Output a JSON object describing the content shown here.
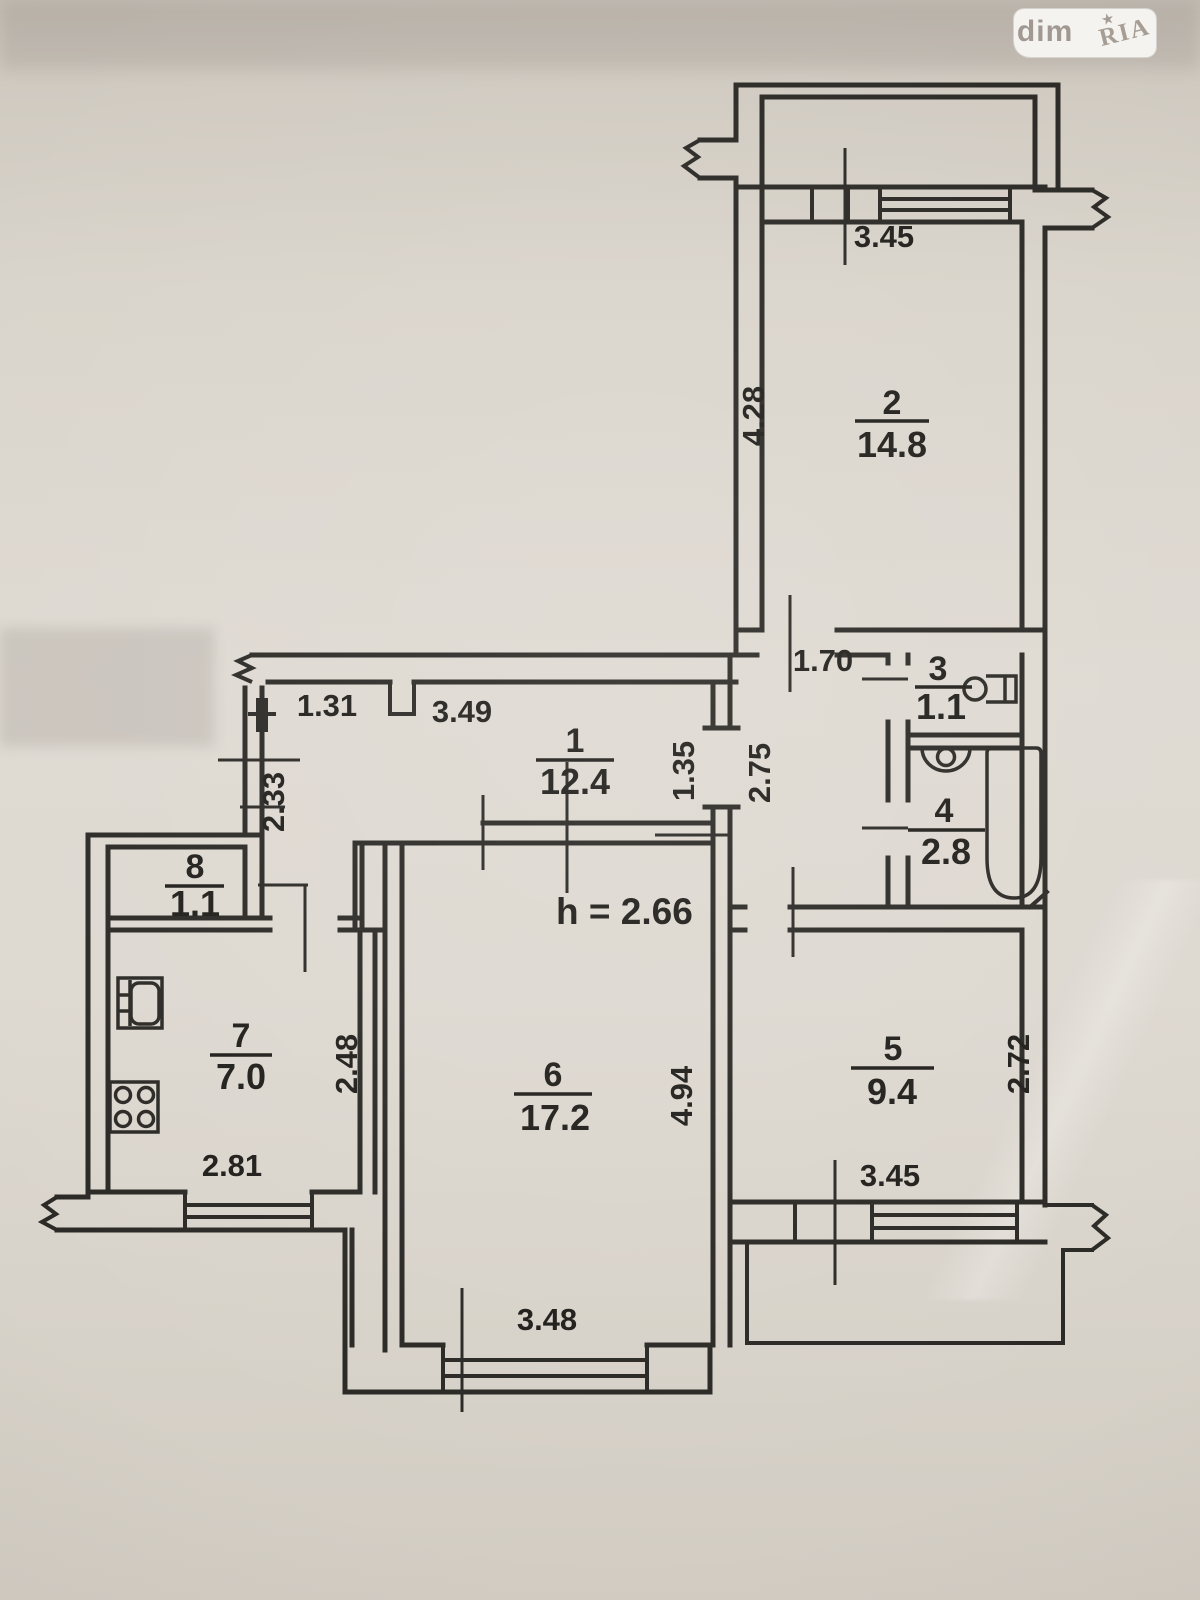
{
  "logo": {
    "left": "dim",
    "right": "RIA",
    "star": "★"
  },
  "plan": {
    "height_note": "h = 2.66",
    "rooms": {
      "r1": {
        "number": "1",
        "area": "12.4"
      },
      "r2": {
        "number": "2",
        "area": "14.8"
      },
      "r3": {
        "number": "3",
        "area": "1.1"
      },
      "r4": {
        "number": "4",
        "area": "2.8"
      },
      "r5": {
        "number": "5",
        "area": "9.4"
      },
      "r6": {
        "number": "6",
        "area": "17.2"
      },
      "r7": {
        "number": "7",
        "area": "7.0"
      },
      "r8": {
        "number": "8",
        "area": "1.1"
      }
    },
    "dims": {
      "top_window": "3.45",
      "room2_height": "4.28",
      "door_width": "1.70",
      "hall_left": "1.31",
      "hall_right": "3.49",
      "hall_pass": "1.35",
      "branch_depth": "2.75",
      "left_wall": "2.33",
      "kitchen_depth": "2.48",
      "kitchen_window": "2.81",
      "room6_window": "3.48",
      "room6_depth": "4.94",
      "room5_depth": "2.72",
      "room5_window": "3.45"
    }
  }
}
